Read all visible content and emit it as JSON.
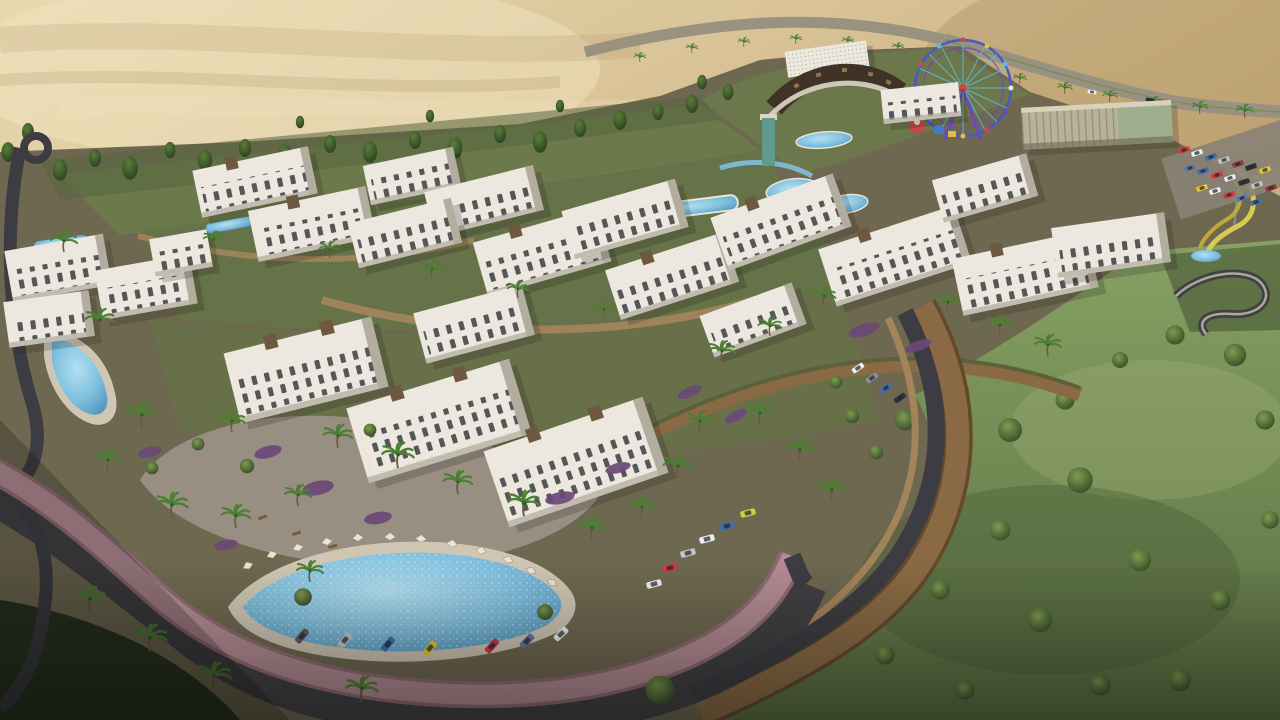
{
  "scene": {
    "description": "Aerial 3D rendering of a hillside resort residential compound at the desert edge: white low-rise apartment blocks with stone stair towers, terraced brick retaining walls, a pink ring road with angle-parked cars, an organic swimming pool ringed by white parasols, a colorful ferris wheel with amusement rides and yellow water slides, a glass clubhouse with parking, a palm-lined desert highway behind, and a large green tree park in the foreground."
  },
  "palette": {
    "sand_light": "#e7d6ac",
    "sand_mid": "#cfb386",
    "sand_dark": "#b6945f",
    "sand_deep": "#9c7c4c",
    "hw_road": "#9a9280",
    "hw_median": "#7a8a5a",
    "tree_dark": "#2c4323",
    "tree_mid": "#44632f",
    "tree_light": "#6f8c46",
    "grass": "#7d9157",
    "grass_light": "#9aab6f",
    "grass_dark": "#4b5c37",
    "site_base": "#6f6850",
    "garden_olive": "#657447",
    "garden_green": "#6b7c4a",
    "bldg_white": "#ece8df",
    "bldg_shade": "#b3ada0",
    "window": "#33363a",
    "stone": "#6e5940",
    "stone_light": "#8d7554",
    "wall": "#8a6a44",
    "wall_dark": "#63492d",
    "wall_light": "#a8875c",
    "road_pink": "#b38b94",
    "road_pink_light": "#c29ba4",
    "road_pink_dark": "#8f6b74",
    "asphalt": "#3c3c42",
    "asphalt_light": "#55555c",
    "pavement": "#9a9184",
    "deck": "#cfc6b4",
    "pool_rim": "#eae5d8",
    "pool": "#7fc0de",
    "pool_deep": "#4e93bb",
    "palm": "#4c7f33",
    "palm_dark": "#335a20",
    "trunk": "#6e5a3e",
    "shrub": "#6a4877",
    "umbrella": "#ece4d2",
    "ferris_blue": "#4858c8",
    "ferris_purple": "#6f49b5",
    "ferris_red": "#cf4545",
    "ferris_cyan": "#58c0d8",
    "ferris_yellow": "#e0c040",
    "glass": "#9fae8d",
    "glass_frame": "#b9b29a",
    "slide": "#d8ca52",
    "roof_dark": "#3f3226",
    "teal": "#5f9a8a",
    "shadow": "#1c1a14"
  },
  "cars": {
    "pool_road": [
      "#585d63",
      "#c3c5c9",
      "#3f6fae",
      "#e5c72f",
      "#d63740",
      "#5c7aa6",
      "#eceef0"
    ],
    "wall_road": [
      "#eceef0",
      "#d63740",
      "#c3c5c9",
      "#eceef0",
      "#3f6fae",
      "#ccd23f"
    ],
    "upper_road": [
      "#eceef0",
      "#8a9098",
      "#3f6fae",
      "#30343a"
    ],
    "parking": [
      "#d63740",
      "#eceef0",
      "#3f6fae",
      "#c3c5c9",
      "#8d3a42",
      "#2f333a",
      "#e5c72f",
      "#5c7aa6"
    ],
    "highway": [
      "#eceef0",
      "#30343a"
    ]
  }
}
